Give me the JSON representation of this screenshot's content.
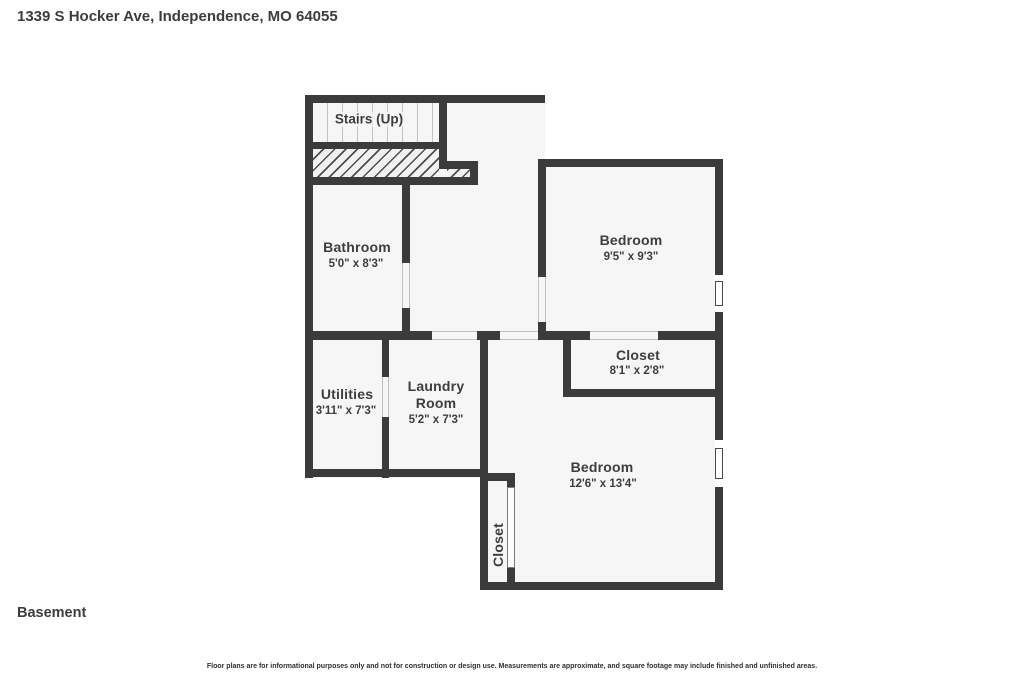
{
  "header": {
    "address": "1339 S Hocker Ave, Independence, MO 64055"
  },
  "floor_label": "Basement",
  "disclaimer": "Floor plans are for informational purposes only and not for construction or design use. Measurements are approximate, and square footage may include finished and unfinished areas.",
  "colors": {
    "wall": "#3b3b3b",
    "interior": "#f6f6f6",
    "background": "#ffffff",
    "text": "#3d3d3d"
  },
  "rooms": {
    "stairs": {
      "label": "Stairs (Up)"
    },
    "bathroom": {
      "label": "Bathroom",
      "dimensions": "5'0\" x 8'3\""
    },
    "bedroom_upper": {
      "label": "Bedroom",
      "dimensions": "9'5\" x 9'3\""
    },
    "closet_upper": {
      "label": "Closet",
      "dimensions": "8'1\" x 2'8\""
    },
    "utilities": {
      "label": "Utilities",
      "dimensions": "3'11\" x 7'3\""
    },
    "laundry": {
      "label_line1": "Laundry",
      "label_line2": "Room",
      "dimensions": "5'2\" x 7'3\""
    },
    "bedroom_lower": {
      "label": "Bedroom",
      "dimensions": "12'6\" x 13'4\""
    },
    "closet_lower": {
      "label": "Closet"
    }
  }
}
